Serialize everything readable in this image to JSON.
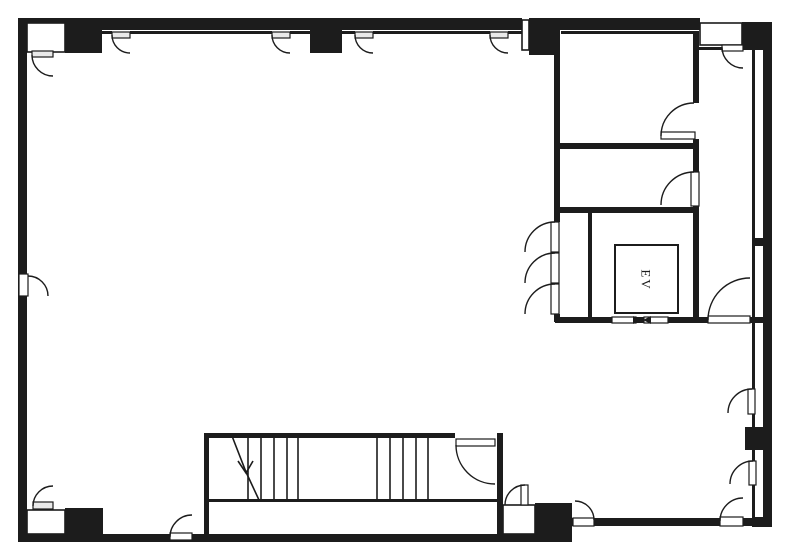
{
  "labels": {
    "elevator": "EV"
  },
  "colors": {
    "wall": "#1c1c1c",
    "line": "#1c1c1c",
    "bg": "#ffffff",
    "leaf": "#ffffff",
    "leaf_shaded": "#e9e9e9"
  },
  "canvas": {
    "width": 787,
    "height": 556
  },
  "plan": {
    "solid_walls": [
      [
        18,
        18,
        9,
        524
      ],
      [
        18,
        18,
        504,
        12
      ],
      [
        560,
        18,
        140,
        12
      ],
      [
        529,
        18,
        31,
        37
      ],
      [
        742,
        22,
        30,
        28
      ],
      [
        763,
        22,
        9,
        505
      ],
      [
        18,
        534,
        554,
        8
      ],
      [
        572,
        518,
        200,
        8
      ],
      [
        752,
        238,
        20,
        8
      ],
      [
        752,
        517,
        20,
        10
      ]
    ],
    "columns": [
      [
        65,
        18,
        37,
        35
      ],
      [
        310,
        18,
        32,
        35
      ],
      [
        65,
        508,
        38,
        29
      ],
      [
        535,
        503,
        37,
        37
      ],
      [
        745,
        427,
        27,
        23
      ]
    ],
    "thin_walls": [
      [
        102,
        31,
        10,
        3
      ],
      [
        130,
        31,
        142,
        3
      ],
      [
        290,
        31,
        20,
        3
      ],
      [
        342,
        31,
        13,
        3
      ],
      [
        373,
        31,
        117,
        3
      ],
      [
        508,
        31,
        14,
        3
      ],
      [
        561,
        31,
        132,
        3
      ],
      [
        554,
        30,
        6,
        192
      ],
      [
        554,
        314,
        6,
        8
      ],
      [
        693,
        31,
        6,
        72
      ],
      [
        693,
        139,
        6,
        33
      ],
      [
        693,
        206,
        6,
        116
      ],
      [
        555,
        143,
        144,
        6
      ],
      [
        555,
        207,
        144,
        6
      ],
      [
        588,
        213,
        4,
        104
      ],
      [
        555,
        317,
        153,
        6
      ],
      [
        750,
        317,
        22,
        6
      ],
      [
        699,
        47,
        23,
        3
      ],
      [
        752,
        50,
        3,
        468
      ],
      [
        204,
        433,
        251,
        5
      ],
      [
        204,
        433,
        5,
        102
      ],
      [
        497,
        433,
        6,
        102
      ],
      [
        208,
        499,
        289,
        3
      ]
    ],
    "openings": [
      [
        27,
        23,
        38,
        29
      ],
      [
        27,
        510,
        38,
        24
      ],
      [
        700,
        23,
        42,
        22
      ],
      [
        522,
        20,
        7,
        30
      ],
      [
        503,
        505,
        32,
        29
      ]
    ],
    "door_leaves": [
      [
        32,
        51,
        21,
        6,
        1
      ],
      [
        112,
        32,
        18,
        6,
        1
      ],
      [
        272,
        32,
        18,
        6,
        1
      ],
      [
        355,
        32,
        18,
        6,
        1
      ],
      [
        490,
        32,
        18,
        6,
        1
      ],
      [
        722,
        45,
        21,
        6,
        0
      ],
      [
        661,
        132,
        34,
        7,
        0
      ],
      [
        691,
        172,
        8,
        34,
        0
      ],
      [
        551,
        222,
        8,
        30,
        0
      ],
      [
        551,
        253,
        8,
        30,
        0
      ],
      [
        551,
        284,
        8,
        30,
        0
      ],
      [
        708,
        316,
        42,
        7,
        0
      ],
      [
        748,
        389,
        7,
        25,
        0
      ],
      [
        749,
        461,
        7,
        24,
        0
      ],
      [
        720,
        517,
        23,
        9,
        0
      ],
      [
        573,
        518,
        21,
        8,
        0
      ],
      [
        521,
        485,
        7,
        20,
        0
      ],
      [
        33,
        502,
        20,
        7,
        1
      ],
      [
        19,
        274,
        9,
        22,
        0
      ],
      [
        170,
        533,
        22,
        7,
        0
      ],
      [
        456,
        439,
        39,
        7,
        0
      ]
    ],
    "door_arcs": [
      [
        32,
        55,
        53,
        76,
        21,
        0
      ],
      [
        112,
        35,
        130,
        53,
        18,
        0
      ],
      [
        272,
        35,
        290,
        53,
        18,
        0
      ],
      [
        355,
        35,
        373,
        53,
        18,
        0
      ],
      [
        490,
        35,
        508,
        53,
        18,
        0
      ],
      [
        722,
        47,
        743,
        68,
        21,
        0
      ],
      [
        661,
        136,
        694,
        103,
        33,
        1
      ],
      [
        661,
        205,
        694,
        172,
        33,
        1
      ],
      [
        525,
        252,
        555,
        222,
        30,
        1
      ],
      [
        525,
        283,
        555,
        253,
        30,
        1
      ],
      [
        525,
        314,
        555,
        284,
        30,
        1
      ],
      [
        708,
        320,
        750,
        278,
        42,
        1
      ],
      [
        728,
        413,
        752,
        389,
        24,
        1
      ],
      [
        730,
        484,
        753,
        461,
        23,
        1
      ],
      [
        720,
        521,
        743,
        498,
        23,
        1
      ],
      [
        594,
        520,
        575,
        501,
        19,
        0
      ],
      [
        505,
        505,
        525,
        485,
        20,
        1
      ],
      [
        33,
        506,
        53,
        486,
        20,
        1
      ],
      [
        28,
        276,
        48,
        296,
        20,
        1
      ],
      [
        170,
        537,
        192,
        515,
        22,
        1
      ],
      [
        456,
        445,
        495,
        484,
        39,
        0
      ]
    ],
    "stair": {
      "treads_x": [
        248,
        261,
        274,
        287,
        298,
        377,
        390,
        403,
        416,
        428
      ],
      "tread_y1": 437,
      "tread_y2": 500,
      "arrow": [
        [
          232,
          436
        ],
        [
          246,
          472
        ],
        [
          259,
          500
        ]
      ],
      "arrow_head": [
        [
          238,
          461
        ],
        [
          246,
          473
        ],
        [
          253,
          461
        ]
      ]
    },
    "elevator": {
      "box": [
        615,
        245,
        63,
        68
      ],
      "label_pos": [
        646,
        280
      ],
      "doors": [
        [
          612,
          317,
          24,
          6
        ],
        [
          644,
          317,
          24,
          6
        ]
      ],
      "markers": [
        [
          [
            633,
            316
          ],
          [
            641,
            320
          ],
          [
            633,
            324
          ]
        ],
        [
          [
            651,
            316
          ],
          [
            643,
            320
          ],
          [
            651,
            324
          ]
        ]
      ]
    }
  }
}
